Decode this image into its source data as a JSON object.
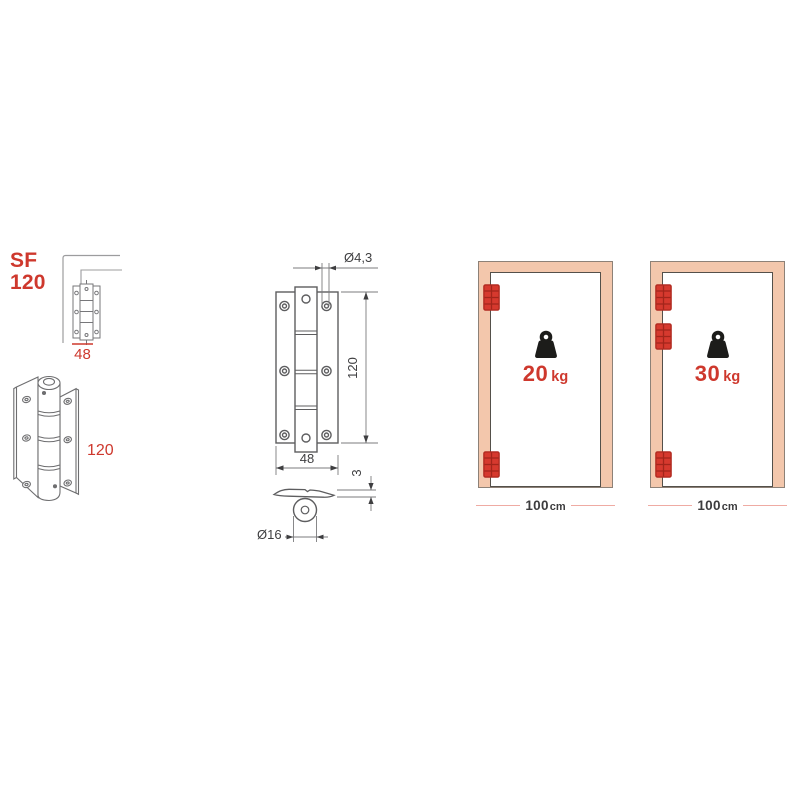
{
  "page": {
    "background": "#ffffff",
    "description": "hinge catalog specification panel"
  },
  "colors": {
    "accent_red": "#ce382d",
    "hinge_red": "#d6392e",
    "hinge_red_dark": "#a3251b",
    "door_frame_fill": "#f3c7ac",
    "door_frame_border": "#8d8177",
    "door_leaf_border": "#54504a",
    "drawing_gray": "#5d5d5f",
    "dimension_text": "#3e3e40",
    "pink_dimension_line": "#efaba3",
    "weight_icon_black": "#1c1c1a"
  },
  "icons": {
    "weight": "kettlebell-weight-icon",
    "hinge": "red-hinge-icon"
  },
  "product": {
    "code_line1": "SF",
    "code_line2": "120",
    "thumb_width_dim": "48",
    "side_height_dim": "120"
  },
  "tech_drawing": {
    "dim_hole_diameter": "Ø4,3",
    "dim_height": "120",
    "dim_width": "48",
    "dim_thickness": "3",
    "dim_barrel_diameter": "Ø16"
  },
  "doors": [
    {
      "weight_value": "20",
      "weight_unit": "kg",
      "width_value": "100",
      "width_unit": "cm",
      "hinge_count": 2
    },
    {
      "weight_value": "30",
      "weight_unit": "kg",
      "width_value": "100",
      "width_unit": "cm",
      "hinge_count": 3
    }
  ]
}
